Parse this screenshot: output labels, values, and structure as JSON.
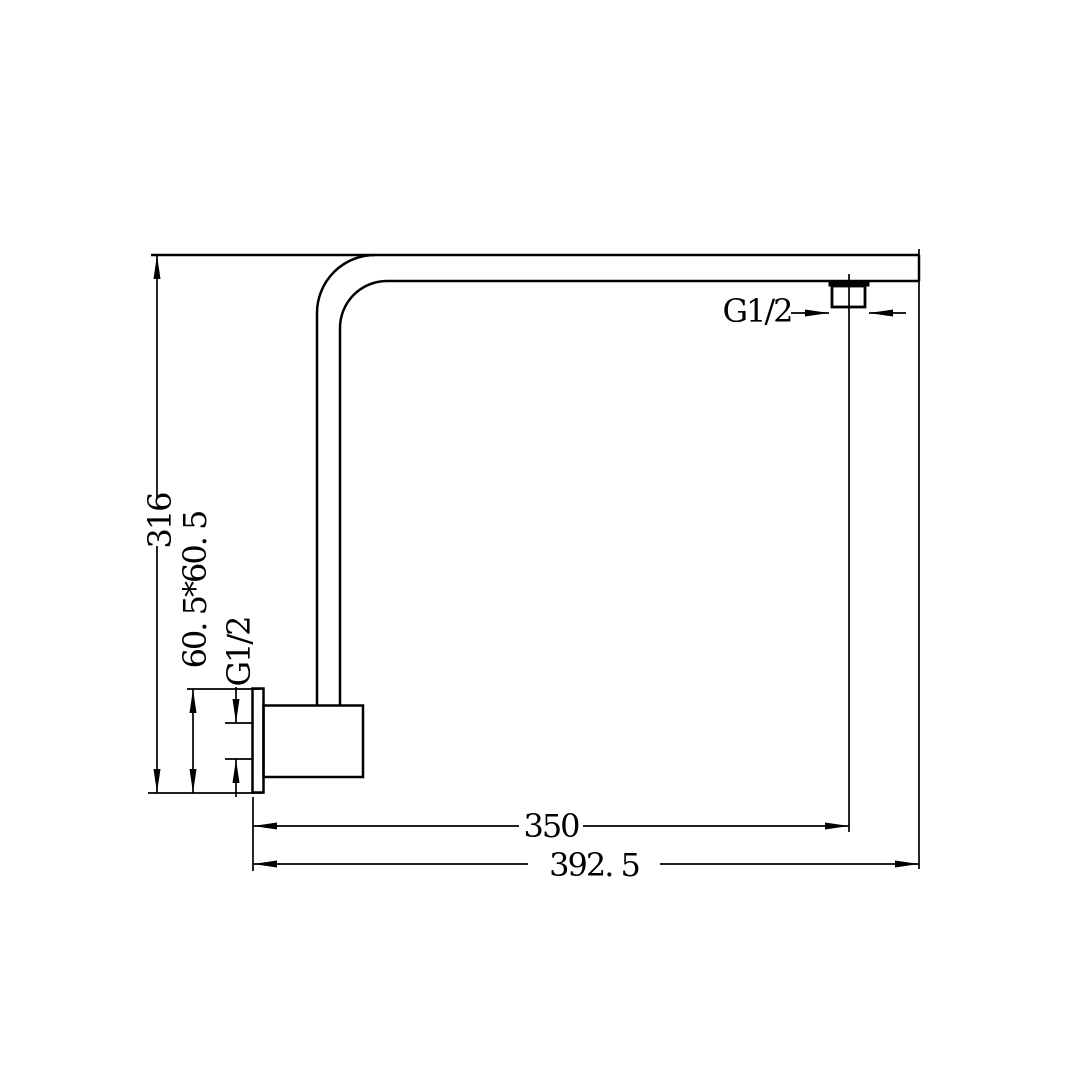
{
  "drawing": {
    "background_color": "#ffffff",
    "line_color": "#000000",
    "labels": {
      "dim_height": "316",
      "dim_plate": "60. 5*60. 5",
      "inlet_thread": "G1/2",
      "outlet_thread": "G1/2",
      "dim_to_outlet": "350",
      "dim_overall": "392. 5"
    }
  }
}
